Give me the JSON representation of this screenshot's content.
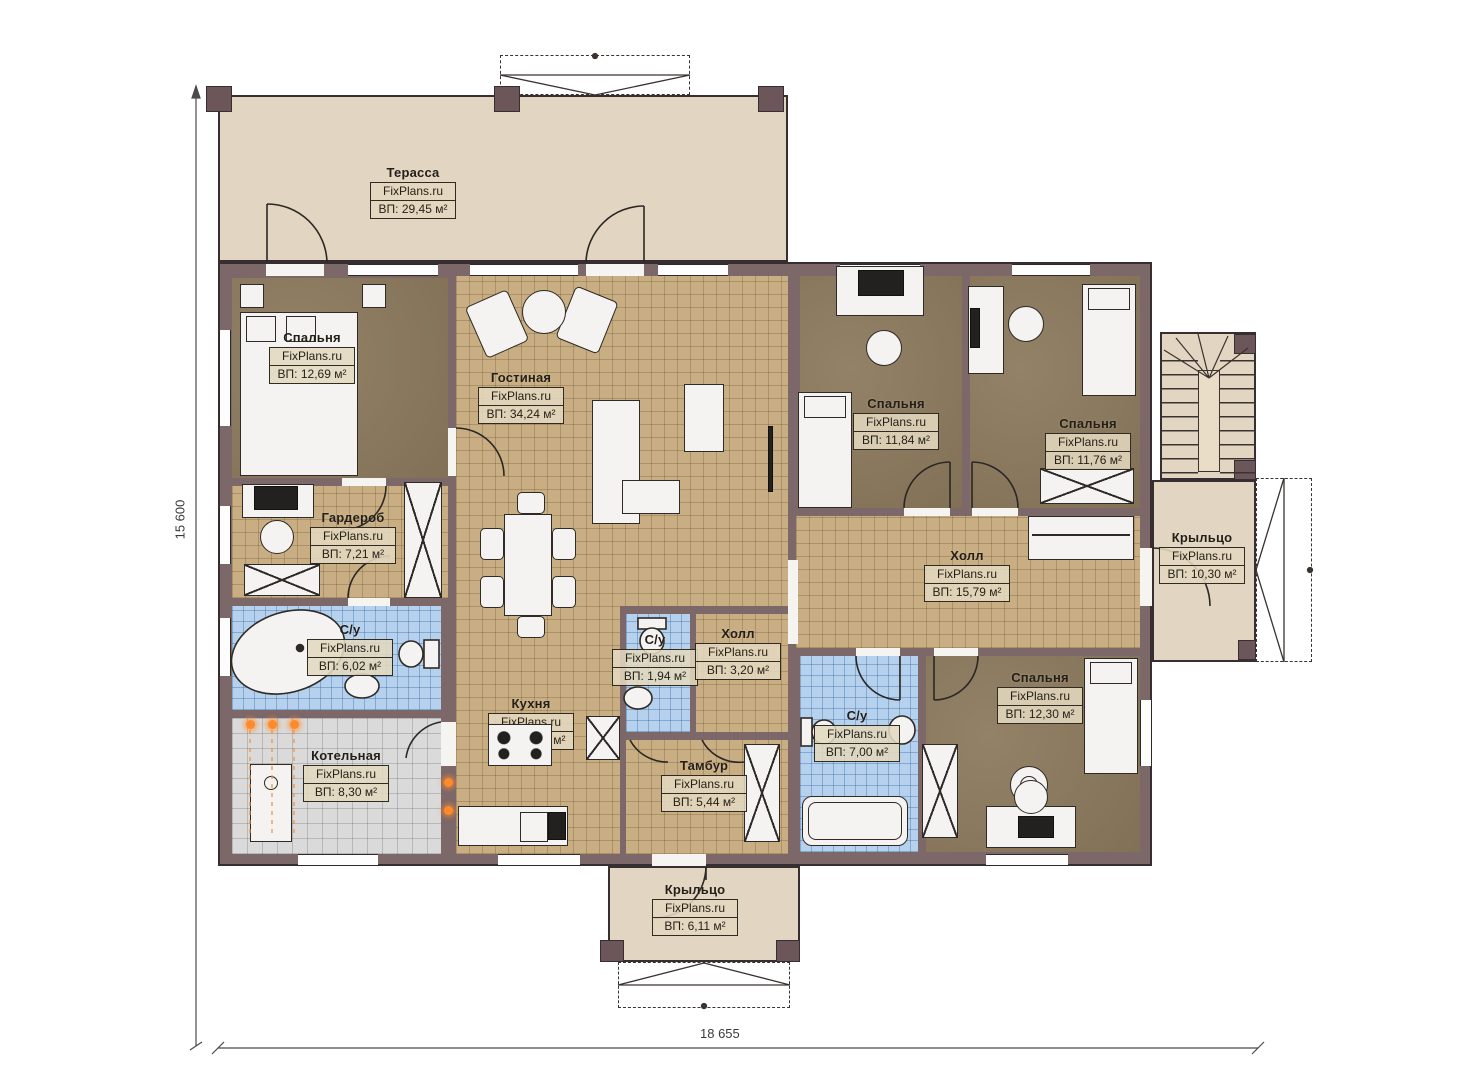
{
  "watermark": "FixPlans.ru",
  "dimensions": {
    "width_label": "18 655",
    "height_label": "15 600"
  },
  "rooms": [
    {
      "name": "Терасса",
      "area": "ВП: 29,45 м²"
    },
    {
      "name": "Спальня",
      "area": "ВП: 12,69 м²"
    },
    {
      "name": "Гостиная",
      "area": "ВП: 34,24 м²"
    },
    {
      "name": "Спальня",
      "area": "ВП: 11,84 м²"
    },
    {
      "name": "Спальня",
      "area": "ВП: 11,76 м²"
    },
    {
      "name": "Гардероб",
      "area": "ВП: 7,21 м²"
    },
    {
      "name": "С/у",
      "area": "ВП: 6,02 м²"
    },
    {
      "name": "Котельная",
      "area": "ВП: 8,30 м²"
    },
    {
      "name": "Кухня",
      "area": "ВП: 13,31 м²"
    },
    {
      "name": "С/у",
      "area": "ВП: 1,94 м²"
    },
    {
      "name": "Холл",
      "area": "ВП: 3,20 м²"
    },
    {
      "name": "Тамбур",
      "area": "ВП: 5,44 м²"
    },
    {
      "name": "Холл",
      "area": "ВП: 15,79 м²"
    },
    {
      "name": "С/у",
      "area": "ВП: 7,00 м²"
    },
    {
      "name": "Спальня",
      "area": "ВП: 12,30 м²"
    },
    {
      "name": "Крыльцо",
      "area": "ВП: 10,30 м²"
    },
    {
      "name": "Крыльцо",
      "area": "ВП: 6,11 м²"
    }
  ],
  "colors": {
    "wall": "#7c6769",
    "terrace_floor": "#e2d5c1",
    "tile_floor": "#c9ae83",
    "bedroom_floor": "#8c7a5d",
    "bathroom_floor": "#b5d1ed",
    "boiler_floor": "#dadada",
    "heating_marker": "#ff8a2a"
  }
}
